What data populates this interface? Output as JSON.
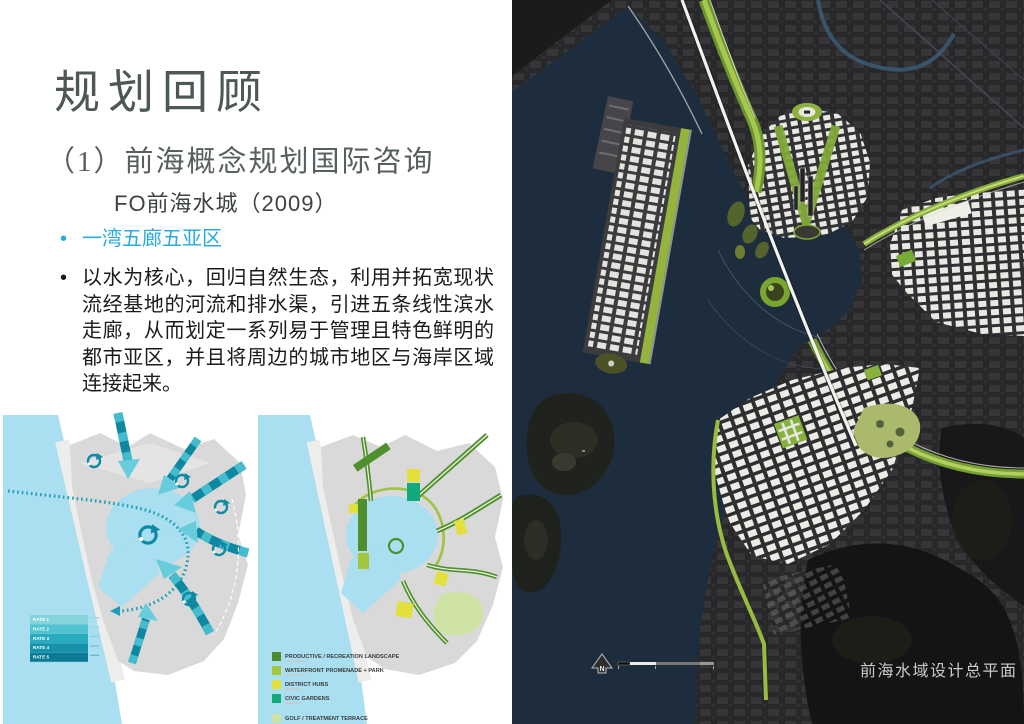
{
  "slide": {
    "title": "规划回顾",
    "subtitle": "（1）前海概念规划国际咨询",
    "project_line": "FO前海水城（2009）",
    "bullet_1": "一湾五廊五亚区",
    "bullet_2": "以水为核心，回归自然生态，利用并拓宽现状流经基地的河流和排水渠，引进五条线性滨水走廊，从而划定一系列易于管理且特色鲜明的都市亚区，并且将周边的城市地区与海岸区域连接起来。",
    "accent_color": "#29abe2"
  },
  "flow_diagram": {
    "name": "water-corridor-flow-diagram",
    "legend": [
      {
        "label": "RATE 1",
        "color": "#85d3db"
      },
      {
        "label": "RATE 2",
        "color": "#52c3d0"
      },
      {
        "label": "RATE 3",
        "color": "#2aacc0"
      },
      {
        "label": "RATE 4",
        "color": "#1693ab"
      },
      {
        "label": "RATE 5",
        "color": "#0c7a94"
      }
    ]
  },
  "landscape_diagram": {
    "name": "landscape-structure-diagram",
    "legend": [
      {
        "label": "PRODUCTIVE / RECREATION LANDSCAPE",
        "color": "#4d8931"
      },
      {
        "label": "WATERFRONT PROMENADE + PARK",
        "color": "#a3c63c"
      },
      {
        "label": "DISTRICT HUBS",
        "color": "#e3df3b"
      },
      {
        "label": "CIVIC GARDENS",
        "color": "#12a97d"
      },
      {
        "label": "GOLF / TREATMENT TERRACE",
        "color": "#cfe3a5"
      }
    ]
  },
  "map": {
    "caption": "前海水域设计总平面",
    "north_label": "N"
  }
}
